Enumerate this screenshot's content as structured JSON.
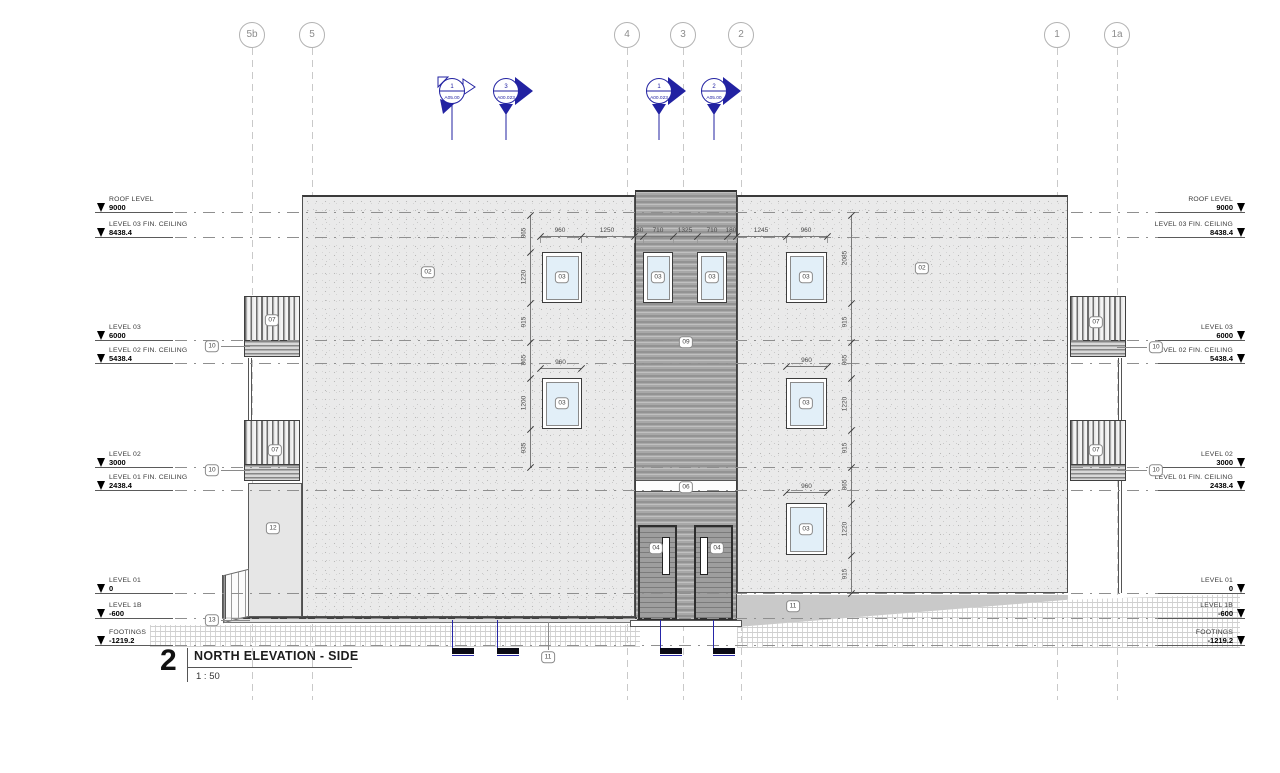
{
  "title_block": {
    "number": "2",
    "title": "NORTH ELEVATION - SIDE",
    "scale": "1 : 50"
  },
  "colors": {
    "section_blue": "#2222a2",
    "wall_fill": "#eaeaea",
    "cladding_fill": "#a8a8a8",
    "glass": "#e2eff8",
    "marker_black": "#0a0a14",
    "level_line": "#8f8f8f",
    "grid_line": "#c9c9c9"
  },
  "grids": [
    {
      "label": "5b",
      "x": 252
    },
    {
      "label": "5",
      "x": 312
    },
    {
      "label": "4",
      "x": 627
    },
    {
      "label": "3",
      "x": 683
    },
    {
      "label": "2",
      "x": 741
    },
    {
      "label": "1",
      "x": 1057
    },
    {
      "label": "1a",
      "x": 1117
    }
  ],
  "levels": [
    {
      "name": "ROOF LEVEL",
      "value": "9000",
      "y": 212
    },
    {
      "name": "LEVEL 03 FIN. CEILING",
      "value": "8438.4",
      "y": 237
    },
    {
      "name": "LEVEL 03",
      "value": "6000",
      "y": 340
    },
    {
      "name": "LEVEL 02 FIN. CEILING",
      "value": "5438.4",
      "y": 363
    },
    {
      "name": "LEVEL 02",
      "value": "3000",
      "y": 467
    },
    {
      "name": "LEVEL 01 FIN. CEILING",
      "value": "2438.4",
      "y": 490
    },
    {
      "name": "LEVEL 01",
      "value": "0",
      "y": 593
    },
    {
      "name": "LEVEL 1B",
      "value": "-600",
      "y": 618
    },
    {
      "name": "FOOTINGS",
      "value": "-1219.2",
      "y": 645
    }
  ],
  "section_markers": [
    {
      "number": "1",
      "sheet": "A05.00",
      "x": 452,
      "style": "open"
    },
    {
      "number": "3",
      "sheet": "A00.023",
      "x": 506,
      "style": "filled"
    },
    {
      "number": "1",
      "sheet": "A00.023",
      "x": 659,
      "style": "filled"
    },
    {
      "number": "2",
      "sheet": "A05.00",
      "x": 714,
      "style": "filled"
    }
  ],
  "keynote_tags": [
    {
      "id": "02",
      "x": 428,
      "y": 272
    },
    {
      "id": "02",
      "x": 922,
      "y": 268
    },
    {
      "id": "03",
      "x": 562,
      "y": 277
    },
    {
      "id": "03",
      "x": 658,
      "y": 277
    },
    {
      "id": "03",
      "x": 712,
      "y": 277
    },
    {
      "id": "03",
      "x": 806,
      "y": 277
    },
    {
      "id": "03",
      "x": 562,
      "y": 403
    },
    {
      "id": "03",
      "x": 806,
      "y": 403
    },
    {
      "id": "03",
      "x": 806,
      "y": 529
    },
    {
      "id": "04",
      "x": 656,
      "y": 548
    },
    {
      "id": "04",
      "x": 717,
      "y": 548
    },
    {
      "id": "06",
      "x": 686,
      "y": 487
    },
    {
      "id": "07",
      "x": 272,
      "y": 320
    },
    {
      "id": "07",
      "x": 275,
      "y": 450
    },
    {
      "id": "07",
      "x": 1096,
      "y": 322
    },
    {
      "id": "07",
      "x": 1096,
      "y": 450
    },
    {
      "id": "09",
      "x": 686,
      "y": 342
    },
    {
      "id": "10",
      "x": 212,
      "y": 346,
      "leader": "right"
    },
    {
      "id": "10",
      "x": 212,
      "y": 470,
      "leader": "right"
    },
    {
      "id": "10",
      "x": 1156,
      "y": 347,
      "leader": "left"
    },
    {
      "id": "10",
      "x": 1156,
      "y": 470,
      "leader": "left"
    },
    {
      "id": "11",
      "x": 548,
      "y": 657,
      "leader": "up"
    },
    {
      "id": "11",
      "x": 793,
      "y": 606
    },
    {
      "id": "12",
      "x": 273,
      "y": 528
    },
    {
      "id": "13",
      "x": 212,
      "y": 620,
      "leader": "right"
    }
  ],
  "dimensions": {
    "top_string": {
      "y": 236,
      "ticks": [
        540,
        581,
        634,
        643,
        673,
        697,
        727,
        736,
        786,
        827
      ],
      "labels": [
        [
          "960",
          560
        ],
        [
          "1250",
          607
        ],
        [
          "180",
          638
        ],
        [
          "710",
          658
        ],
        [
          "1325",
          685
        ],
        [
          "710",
          712
        ],
        [
          "180",
          731
        ],
        [
          "1245",
          761
        ],
        [
          "960",
          806
        ]
      ]
    },
    "left_column": {
      "x": 530,
      "ticks": [
        215,
        252,
        303,
        342,
        378,
        429,
        467
      ],
      "labels": [
        [
          "865",
          233
        ],
        [
          "1220",
          277
        ],
        [
          "915",
          322
        ],
        [
          "865",
          360
        ],
        [
          "1200",
          403
        ],
        [
          "935",
          448
        ]
      ]
    },
    "right_column": {
      "x": 851,
      "ticks": [
        215,
        303,
        342,
        378,
        430,
        467,
        503,
        555,
        593
      ],
      "labels": [
        [
          "2085",
          258
        ],
        [
          "915",
          322
        ],
        [
          "865",
          360
        ],
        [
          "1220",
          404
        ],
        [
          "915",
          448
        ],
        [
          "865",
          485
        ],
        [
          "1220",
          529
        ],
        [
          "915",
          574
        ]
      ]
    },
    "width_dims": [
      {
        "label": "960",
        "x1": 540,
        "x2": 581,
        "y": 368
      },
      {
        "label": "960",
        "x1": 786,
        "x2": 827,
        "y": 366
      },
      {
        "label": "960",
        "x1": 786,
        "x2": 827,
        "y": 492
      }
    ]
  },
  "geometry": {
    "windows": [
      {
        "x": 542,
        "y": 252,
        "w": 40,
        "h": 51
      },
      {
        "x": 643,
        "y": 252,
        "w": 30,
        "h": 51
      },
      {
        "x": 697,
        "y": 252,
        "w": 30,
        "h": 51
      },
      {
        "x": 786,
        "y": 252,
        "w": 41,
        "h": 51
      },
      {
        "x": 542,
        "y": 378,
        "w": 40,
        "h": 51
      },
      {
        "x": 786,
        "y": 378,
        "w": 41,
        "h": 51
      },
      {
        "x": 786,
        "y": 503,
        "w": 41,
        "h": 52
      }
    ],
    "doors": [
      {
        "x": 638,
        "y": 525,
        "w": 39,
        "h": 95,
        "slot_x": 22
      },
      {
        "x": 694,
        "y": 525,
        "w": 39,
        "h": 95,
        "slot_x": 4
      }
    ],
    "balconies": [
      {
        "x": 244,
        "y": 296,
        "w": 56
      },
      {
        "x": 244,
        "y": 420,
        "w": 56
      },
      {
        "x": 1070,
        "y": 296,
        "w": 56
      },
      {
        "x": 1070,
        "y": 420,
        "w": 56
      }
    ],
    "posts": [
      {
        "x": 248,
        "y": 358,
        "h": 62
      },
      {
        "x": 1118,
        "y": 358,
        "h": 62
      },
      {
        "x": 1118,
        "y": 480,
        "h": 113
      }
    ],
    "ground_markers": [
      452,
      497,
      660,
      713
    ]
  }
}
